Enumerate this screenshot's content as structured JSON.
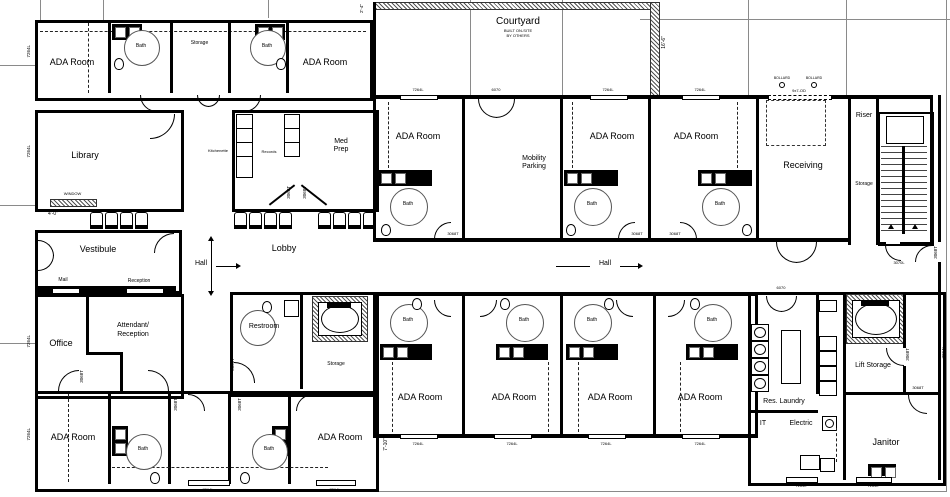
{
  "plan": {
    "rooms": {
      "ada_room": "ADA Room",
      "bath": "Bath",
      "storage": "Storage",
      "library": "Library",
      "kitchenette": "Kitchenette",
      "records": "Records",
      "med_prep": "Med Prep",
      "vestibule": "Vestibule",
      "office": "Office",
      "attendant_1": "Attendant/",
      "attendant_2": "Reception",
      "lobby": "Lobby",
      "restroom": "Restroom",
      "courtyard": "Courtyard",
      "mobility_parking": "Mobility Parking",
      "receiving": "Receiving",
      "riser": "Riser",
      "res_laundry": "Res. Laundry",
      "it": "IT",
      "electric": "Electric",
      "lift_storage": "Lift Storage",
      "janitor": "Janitor"
    },
    "annotations": {
      "hall": "Hall",
      "window": "WINDOW",
      "mail": "Mail",
      "reception": "Reception",
      "courtyard_note_1": "BUILT ON-SITE",
      "courtyard_note_2": "BY OTHERS"
    },
    "dimensions": {
      "courtyard_side": "16'-6\"",
      "library_left": "4'-0\"",
      "wing_right": "7'-10\"",
      "top_left": "2'-4\""
    },
    "tags": {
      "window": "7264L",
      "door": "3068T",
      "double_door": "6070",
      "overhead_door": "9x7-OD",
      "bollard": "BOLLARD",
      "stair_door": "3070L"
    },
    "colors": {
      "wall": "#000000",
      "grid": "#8a8a8a",
      "paper": "#ffffff"
    }
  }
}
